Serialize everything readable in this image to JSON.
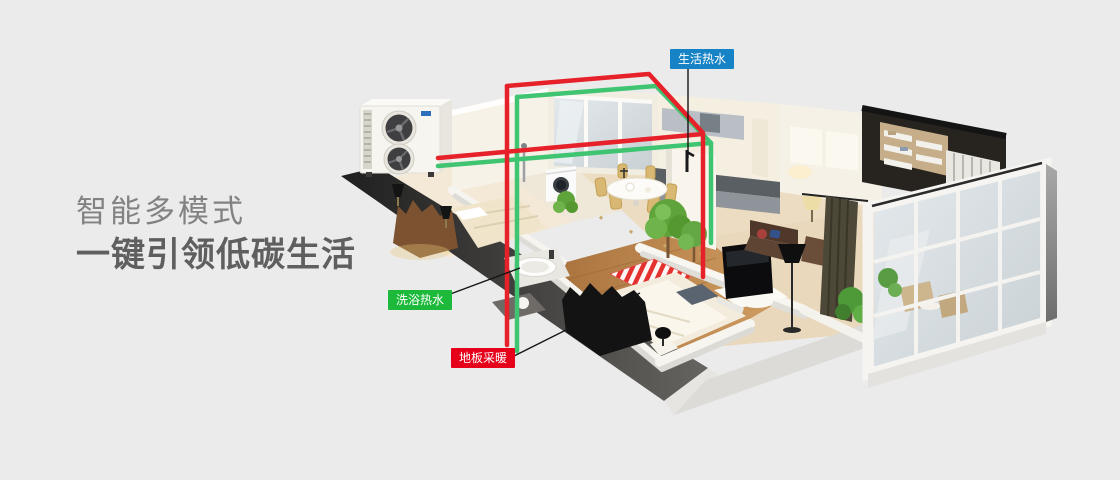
{
  "background_color": "#ebebeb",
  "headline": {
    "line1": "智能多模式",
    "line2": "一键引领低碳生活",
    "line1_color": "#828282",
    "line2_color": "#5f5f5f"
  },
  "callouts": [
    {
      "id": "domestic-hot-water",
      "text": "生活热水",
      "color": "#1583c5"
    },
    {
      "id": "bathing-hot-water",
      "text": "洗浴热水",
      "color": "#1db93a"
    },
    {
      "id": "floor-heating",
      "text": "地板采暖",
      "color": "#e60019"
    }
  ],
  "pipes": {
    "supply_color": "#e62129",
    "return_color": "#3fc471"
  }
}
